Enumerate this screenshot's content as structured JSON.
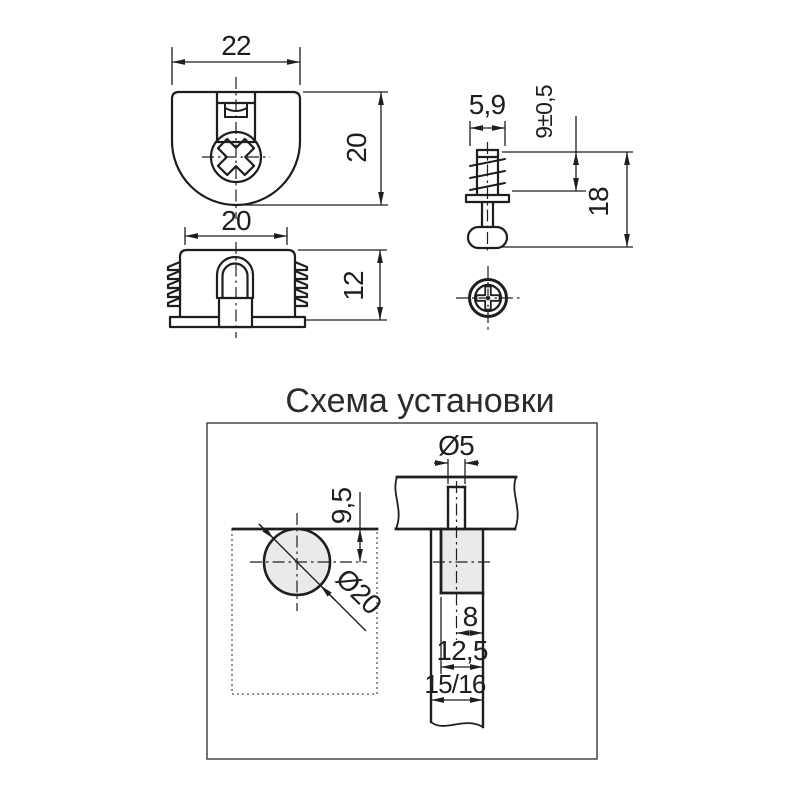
{
  "title": "Схема установки",
  "colors": {
    "line": "#1e1e1e",
    "fill": "#eaeaea",
    "background": "#ffffff"
  },
  "cam_top_view": {
    "width": "22",
    "height": "20"
  },
  "cam_side_view": {
    "width": "20",
    "height": "12"
  },
  "dowel_view": {
    "thread_diameter": "5,9",
    "thread_length": "9±0,5",
    "total_length": "18"
  },
  "installation": {
    "pin_hole_diameter": "Ø5",
    "edge_distance": "9,5",
    "cam_hole_diameter": "Ø20",
    "pin_axis_offset": "8",
    "cam_hole_depth": "12,5",
    "panel_thickness": "15/16"
  }
}
